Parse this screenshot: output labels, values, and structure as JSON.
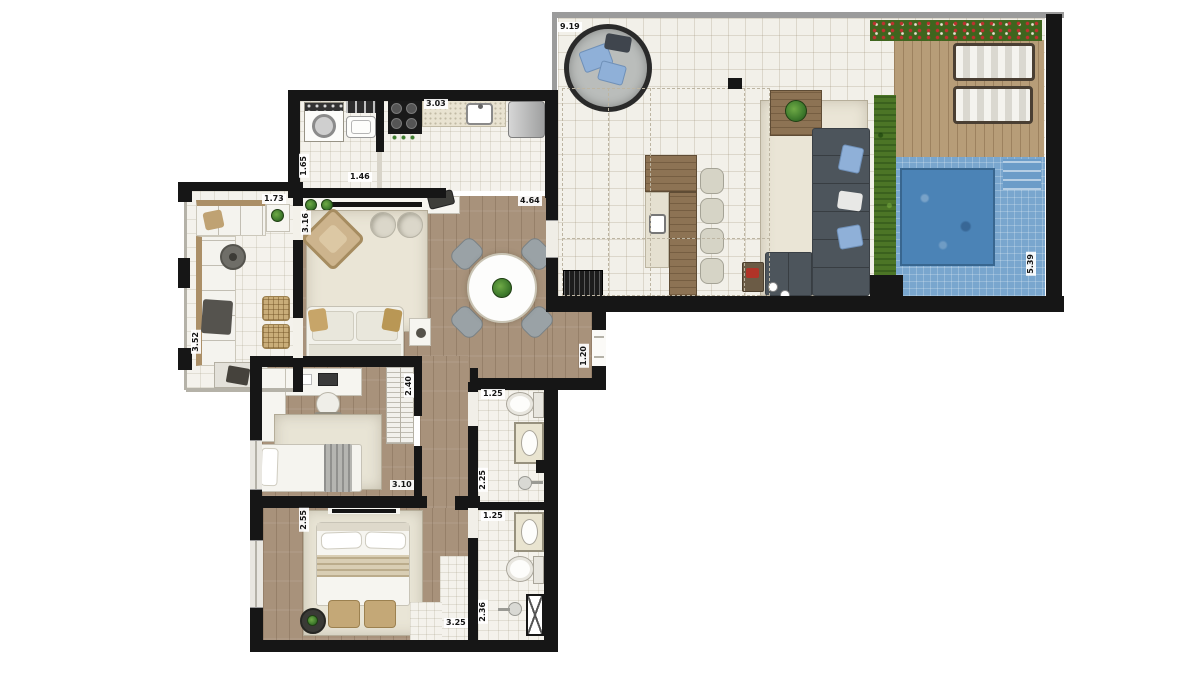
{
  "labels": {
    "terrace_width": "9.19",
    "terrace_depth": "5.39",
    "kitchen_width": "3.03",
    "laundry_width": "1.46",
    "laundry_depth": "1.65",
    "living_width": "4.64",
    "living_depth": "3.16",
    "entry_opening": "1.20",
    "lounge_width": "1.73",
    "lounge_depth": "3.52",
    "bedroom2_width": "3.10",
    "bedroom2_depth": "2.40",
    "bath1_width": "1.25",
    "bath1_depth": "2.25",
    "bath2_width": "1.25",
    "bath2_depth": "2.36",
    "master_width": "3.25",
    "master_depth": "2.55"
  },
  "colors": {
    "wall": "#161616",
    "wood_floor": "#a8927b",
    "deck_wood": "#b79d78",
    "tile": "#f2f0e9",
    "pool_water": "#4b83b6",
    "pool_surround": "#79a6ce",
    "hedge_green": "#4c7526",
    "plant_green": "#3e7a2c",
    "sofa_gray": "#4d555c",
    "cushion_blue": "#8fb0d8",
    "rug_beige": "#eae5d6",
    "accent_red": "#b03428"
  }
}
